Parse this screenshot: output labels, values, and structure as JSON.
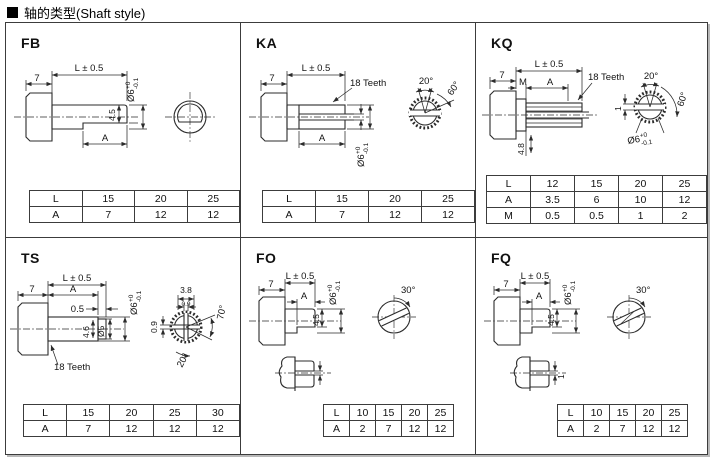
{
  "header": {
    "marker": "■",
    "title": "轴的类型(Shaft style)"
  },
  "panels": [
    {
      "id": "fb",
      "label": "FB",
      "dims": {
        "L": "L ± 0.5",
        "seven": "7",
        "dia": "Ø6",
        "tol_top": "+0",
        "tol_bot": "-0.1",
        "h45": "4.5",
        "A": "A"
      },
      "table": {
        "rows": [
          [
            "L",
            "15",
            "20",
            "25"
          ],
          [
            "A",
            "7",
            "12",
            "12"
          ]
        ]
      }
    },
    {
      "id": "ka",
      "label": "KA",
      "dims": {
        "L": "L ± 0.5",
        "seven": "7",
        "teeth": "18 Teeth",
        "A": "A",
        "dia": "Ø6",
        "tol_top": "+0",
        "tol_bot": "-0.1",
        "a20": "20°",
        "a60": "60°"
      },
      "table": {
        "rows": [
          [
            "L",
            "15",
            "20",
            "25"
          ],
          [
            "A",
            "7",
            "12",
            "12"
          ]
        ]
      }
    },
    {
      "id": "kq",
      "label": "KQ",
      "dims": {
        "L": "L ± 0.5",
        "seven": "7",
        "M": "M",
        "A": "A",
        "teeth": "18 Teeth",
        "h48": "4.8",
        "one": "1",
        "a20": "20°",
        "a60": "60°",
        "dia": "Ø6",
        "tol_top": "+0",
        "tol_bot": "-0.1"
      },
      "table": {
        "rows": [
          [
            "L",
            "12",
            "15",
            "20",
            "25"
          ],
          [
            "A",
            "3.5",
            "6",
            "10",
            "12"
          ],
          [
            "M",
            "0.5",
            "0.5",
            "1",
            "2"
          ]
        ]
      }
    },
    {
      "id": "ts",
      "label": "TS",
      "dims": {
        "L": "L ± 0.5",
        "seven": "7",
        "A": "A",
        "p05": "0.5",
        "dia": "Ø6",
        "tol_top": "+0",
        "tol_bot": "-0.1",
        "h46": "4.6",
        "dia5": "Ø5",
        "teeth": "18 Teeth",
        "w38": "3.8",
        "w09": "0.9",
        "h09": "0.9",
        "a70": "70°",
        "a20": "20°"
      },
      "table": {
        "rows": [
          [
            "L",
            "15",
            "20",
            "25",
            "30"
          ],
          [
            "A",
            "7",
            "12",
            "12",
            "12"
          ]
        ]
      }
    },
    {
      "id": "fo",
      "label": "FO",
      "dims": {
        "L": "L ± 0.5",
        "seven": "7",
        "A": "A",
        "dia": "Ø6",
        "tol_top": "+0",
        "tol_bot": "-0.1",
        "h45": "4.5",
        "a30": "30°"
      },
      "table": {
        "rows": [
          [
            "L",
            "10",
            "15",
            "20",
            "25"
          ],
          [
            "A",
            "2",
            "7",
            "12",
            "12"
          ]
        ]
      }
    },
    {
      "id": "fq",
      "label": "FQ",
      "dims": {
        "L": "L ± 0.5",
        "seven": "7",
        "A": "A",
        "dia": "Ø6",
        "tol_top": "+0",
        "tol_bot": "-0.1",
        "h45": "4.5",
        "a30": "30°",
        "one": "1"
      },
      "table": {
        "rows": [
          [
            "L",
            "10",
            "15",
            "20",
            "25"
          ],
          [
            "A",
            "2",
            "7",
            "12",
            "12"
          ]
        ]
      }
    }
  ]
}
